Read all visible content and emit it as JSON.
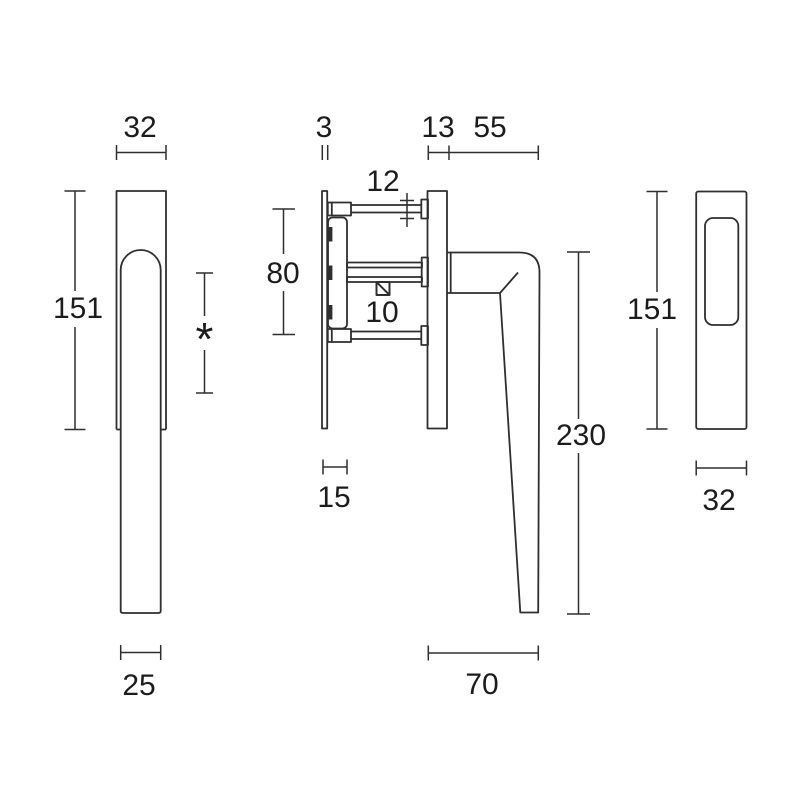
{
  "colors": {
    "line": "#2f2f2f",
    "text": "#1c1c1c",
    "background": "#ffffff"
  },
  "views": {
    "front": {
      "dims": {
        "width_top": "32",
        "height": "151",
        "variable": "*",
        "width_bottom": "25"
      }
    },
    "side": {
      "dims": {
        "plate_thickness": "3",
        "rosette_depth": "13",
        "grip_depth": "55",
        "screw_boss_dia": "12",
        "screw_spacing": "80",
        "spindle_square": "10",
        "base_depth": "15",
        "handle_length": "230",
        "projection": "70"
      }
    },
    "back": {
      "dims": {
        "height": "151",
        "width": "32"
      }
    }
  }
}
